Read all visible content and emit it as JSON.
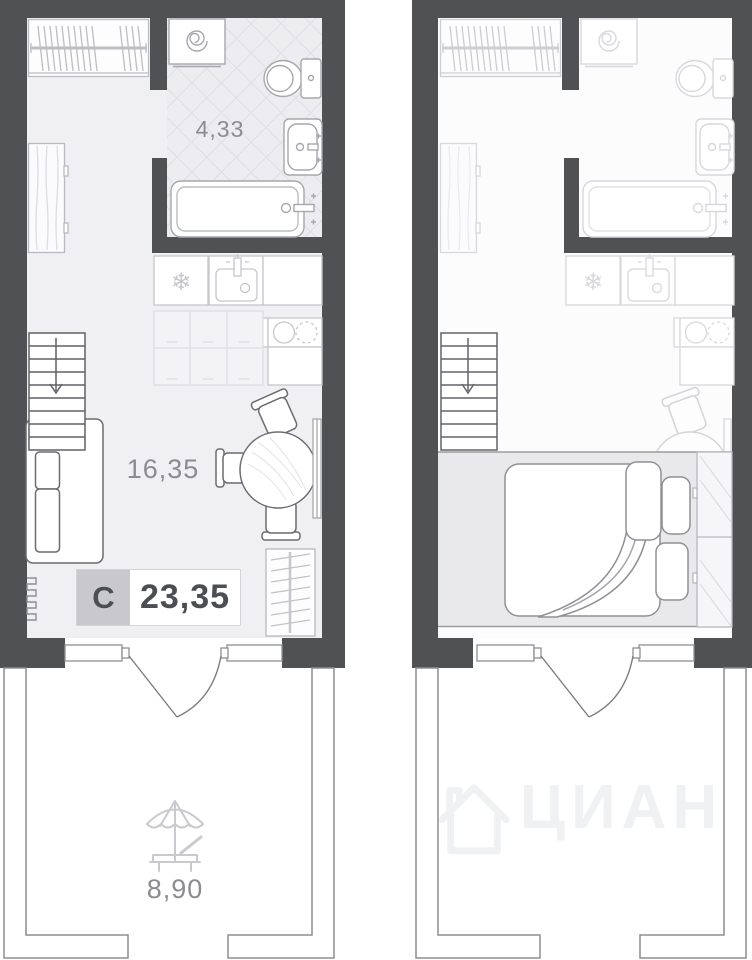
{
  "colors": {
    "wall": "#505153",
    "room_left_bg": "#f0f0f2",
    "room_right_bg": "#fcfcfd",
    "bath_bg": "#ededf0",
    "tile_line": "#dfdfe6",
    "shade_bg": "#e9e9eb",
    "label_text": "#8b8b91",
    "badge_gray": "#c9c9cd",
    "badge_text": "#4b4e53",
    "watermark": "#eff1f2"
  },
  "left_panel": {
    "bathroom_area_label": "4,33",
    "living_area_label": "16,35",
    "terrace_area_label": "8,90",
    "badge": {
      "letter": "С",
      "total_area": "23,35"
    }
  },
  "right_panel": {
    "watermark_text": "ЦИАН"
  }
}
